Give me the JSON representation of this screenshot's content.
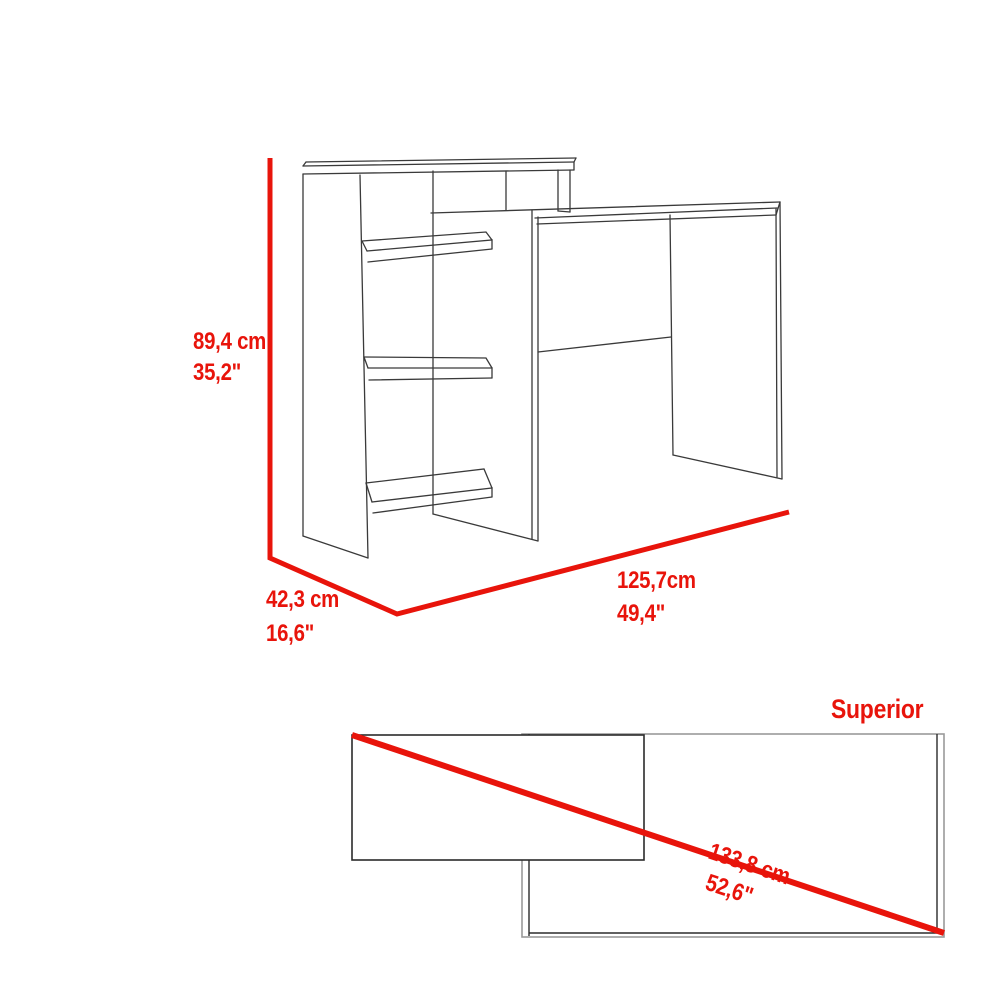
{
  "diagram": {
    "front_view": {
      "height_cm": "89,4 cm",
      "height_in": "35,2\"",
      "depth_cm": "42,3 cm",
      "depth_in": "16,6\"",
      "width_cm": "125,7cm",
      "width_in": "49,4\""
    },
    "top_view": {
      "title": "Superior",
      "diagonal_cm": "133,8 cm",
      "diagonal_in": "52,6\""
    },
    "colors": {
      "dimension_red": "#e8140b",
      "outline_dark": "#3a3a3a",
      "outline_gray": "#9a9a9a"
    }
  }
}
